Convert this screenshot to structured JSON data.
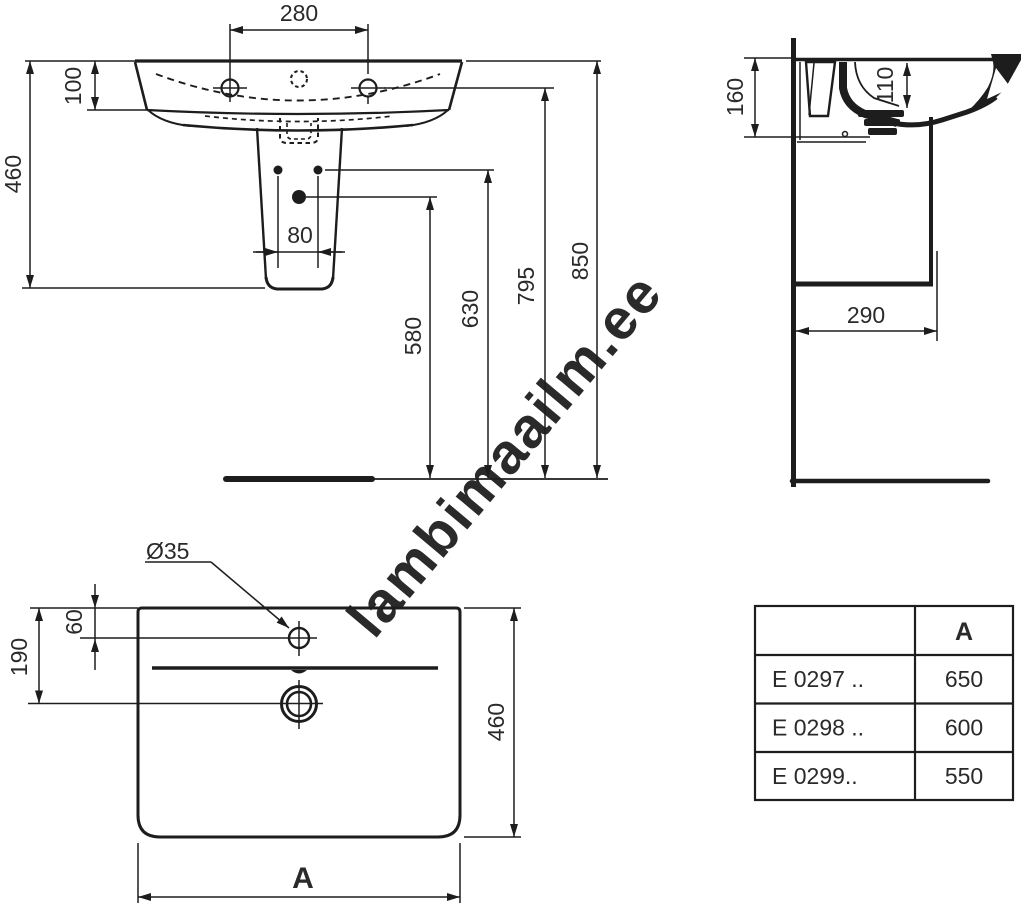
{
  "watermark": {
    "text": "lambimaailm.ee",
    "color": "#d2d2d2"
  },
  "drawing": {
    "line_color": "#1d1d1d",
    "text_color": "#2a2a2a"
  },
  "front_view": {
    "dims": {
      "tap_hole_spacing": "280",
      "rim_depth": "100",
      "height_with_pedestal": "460",
      "fixing_hole_spacing": "80",
      "drain_to_floor": "580",
      "fixings_to_floor": "630",
      "underside_to_floor": "795",
      "rim_to_floor": "850"
    }
  },
  "side_view": {
    "dims": {
      "wall_to_overflow": "160",
      "inner_depth": "110",
      "wall_to_front_fixing": "290"
    }
  },
  "top_view": {
    "dims": {
      "tap_hole_diameter": "Ø35",
      "rim_to_tap_hole": "60",
      "rim_to_drain": "190",
      "depth": "460",
      "width_label": "A"
    }
  },
  "spec_table": {
    "col_a_header": "A",
    "rows": [
      {
        "code": "E 0297 ..",
        "a": "650"
      },
      {
        "code": "E 0298 ..",
        "a": "600"
      },
      {
        "code": "E 0299..",
        "a": "550"
      }
    ]
  }
}
